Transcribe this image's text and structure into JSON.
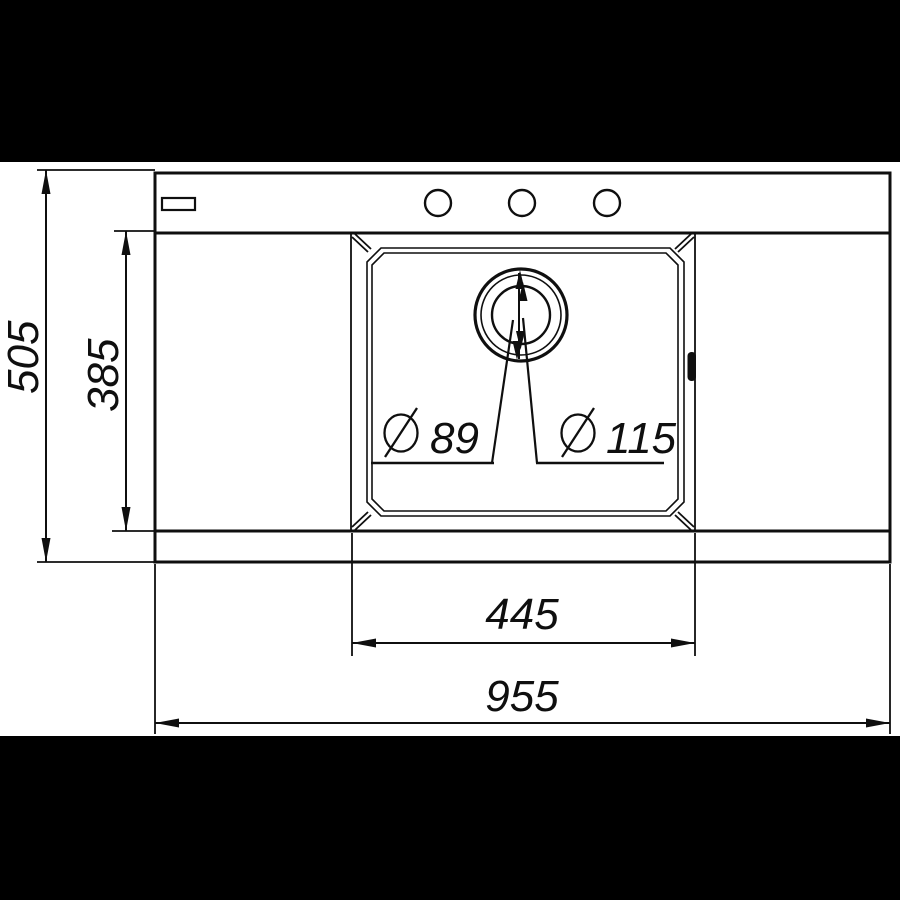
{
  "diagram": {
    "labels": {
      "overall_depth": "505",
      "bowl_depth": "385",
      "bowl_width": "445",
      "overall_width": "955",
      "diameter_symbol": "Ø",
      "drain_inner": "89",
      "drain_outer": "115"
    },
    "colors": {
      "ink": "#0f0f0f",
      "paper": "#ffffff",
      "letterbox": "#000000"
    }
  }
}
